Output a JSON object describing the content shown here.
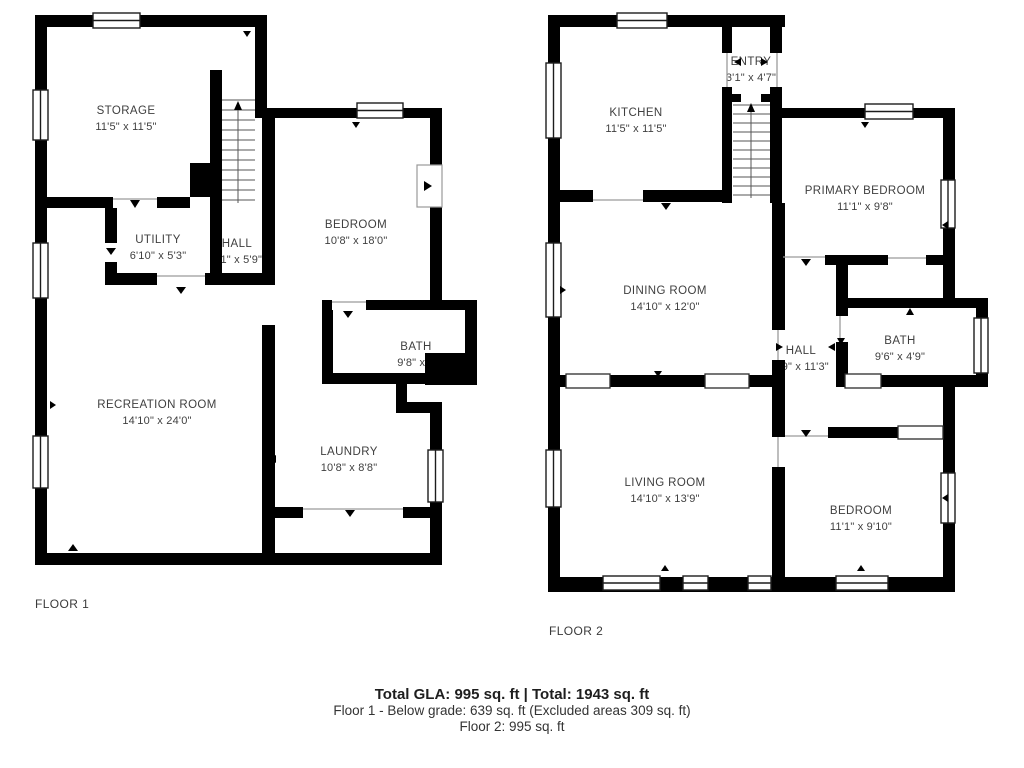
{
  "floor1": {
    "label": "FLOOR 1",
    "rooms": {
      "storage": {
        "name": "STORAGE",
        "dims": "11'5\" x 11'5\""
      },
      "utility": {
        "name": "UTILITY",
        "dims": "6'10\" x 5'3\""
      },
      "hall": {
        "name": "HALL",
        "dims": "3'1\" x 5'9\""
      },
      "bedroom": {
        "name": "BEDROOM",
        "dims": "10'8\" x 18'0\""
      },
      "bath": {
        "name": "BATH",
        "dims": "9'8\" x 7"
      },
      "laundry": {
        "name": "LAUNDRY",
        "dims": "10'8\" x 8'8\""
      },
      "recreation": {
        "name": "RECREATION ROOM",
        "dims": "14'10\" x 24'0\""
      }
    }
  },
  "floor2": {
    "label": "FLOOR 2",
    "rooms": {
      "kitchen": {
        "name": "KITCHEN",
        "dims": "11'5\" x 11'5\""
      },
      "entry": {
        "name": "ENTRY",
        "dims": "3'1\" x 4'7\""
      },
      "primary": {
        "name": "PRIMARY BEDROOM",
        "dims": "11'1\" x 9'8\""
      },
      "dining": {
        "name": "DINING ROOM",
        "dims": "14'10\" x 12'0\""
      },
      "hall": {
        "name": "HALL",
        "dims": "3'9\" x 11'3\""
      },
      "bath": {
        "name": "BATH",
        "dims": "9'6\" x 4'9\""
      },
      "living": {
        "name": "LIVING ROOM",
        "dims": "14'10\" x 13'9\""
      },
      "bedroom": {
        "name": "BEDROOM",
        "dims": "11'1\" x 9'10\""
      }
    }
  },
  "footer": {
    "line1": "Total GLA: 995 sq. ft | Total: 1943 sq. ft",
    "line2": "Floor 1 - Below grade: 639 sq. ft (Excluded areas 309 sq. ft)",
    "line3": "Floor 2: 995 sq. ft"
  },
  "colors": {
    "wall": "#000000",
    "label_text": "#3f3f3f"
  }
}
